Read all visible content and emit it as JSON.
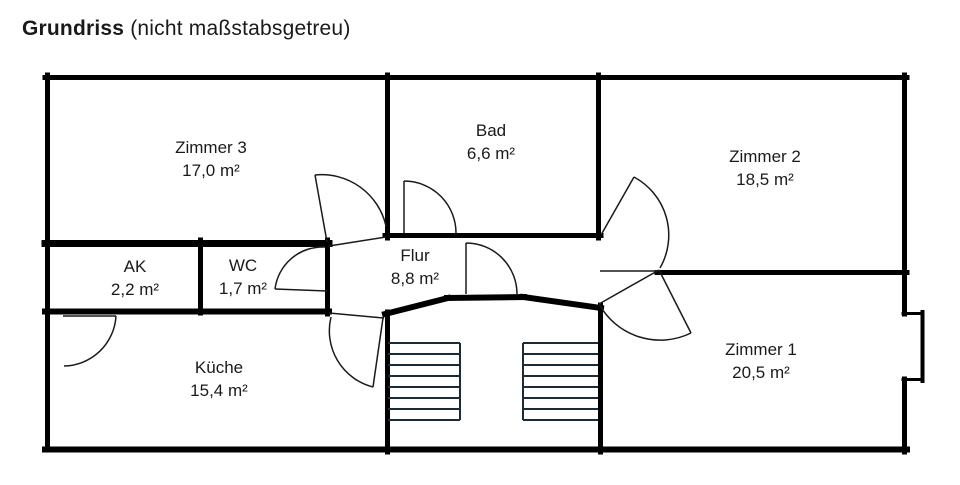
{
  "title": {
    "main": "Grundriss",
    "suffix": " (nicht maßstabsgetreu)"
  },
  "rooms": {
    "zimmer3": {
      "name": "Zimmer 3",
      "area": "17,0 m²"
    },
    "bad": {
      "name": "Bad",
      "area": "6,6 m²"
    },
    "zimmer2": {
      "name": "Zimmer 2",
      "area": "18,5 m²"
    },
    "ak": {
      "name": "AK",
      "area": "2,2 m²"
    },
    "wc": {
      "name": "WC",
      "area": "1,7 m²"
    },
    "flur": {
      "name": "Flur",
      "area": "8,8 m²"
    },
    "kueche": {
      "name": "Küche",
      "area": "15,4 m²"
    },
    "zimmer1": {
      "name": "Zimmer 1",
      "area": "20,5 m²"
    }
  },
  "colors": {
    "wall": "#000000",
    "door_line": "#1a1a1a",
    "stair_tread": "#1c2b36"
  }
}
